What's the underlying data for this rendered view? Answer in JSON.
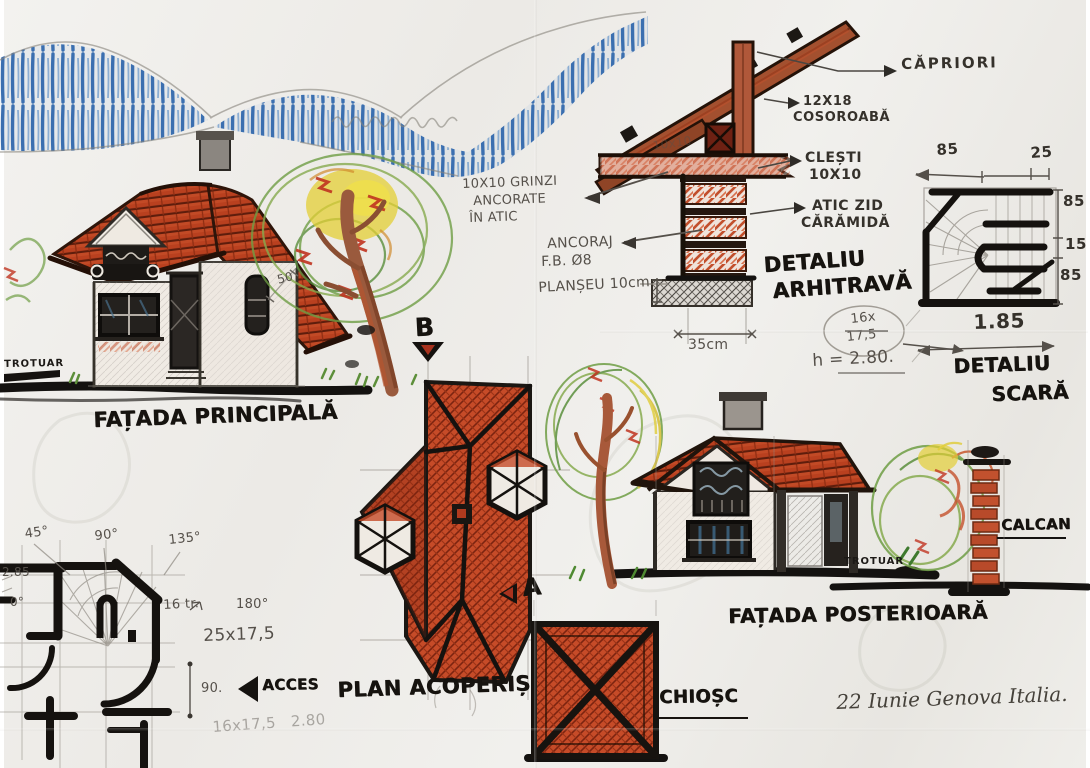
{
  "colors": {
    "paper": "#efeeea",
    "ink": "#16130f",
    "pencil": "#55504a",
    "roof_red": "#b9401f",
    "brick_red": "#c4512c",
    "sky_blue": "#3b6fb0",
    "leaf_green": "#6f9e45",
    "leaf_yellow": "#e3cf36",
    "trunk_brown": "#9a5a3d"
  },
  "facade_principala": {
    "caption": "FAȚADA PRINCIPALĂ",
    "trotuar": "TROTUAR",
    "dim_50": "50"
  },
  "facade_posterioara": {
    "caption": "FAȚADA POSTERIOARĂ",
    "trotuar": "TROTUAR",
    "calcan": "CALCAN"
  },
  "roof_plan": {
    "caption": "PLAN ACOPERIȘ",
    "acces": "ACCES",
    "marker_a": "A",
    "marker_b": "B"
  },
  "kiosk": {
    "caption": "CHIOȘC"
  },
  "detaliu_arhitrava": {
    "caption_line1": "DETALIU",
    "caption_line2": "ARHITRAVĂ",
    "capriori": "CĂPRIORI",
    "cosoroaba_line1": "12X18",
    "cosoroaba_line2": "COSOROABĂ",
    "clesti_line1": "CLEȘTI",
    "clesti_line2": "10X10",
    "atic_line1": "ATIC ZID",
    "atic_line2": "CĂRĂMIDĂ",
    "grinzi_line1": "10X10 GRINZI",
    "grinzi_line2": "ANCORATE",
    "grinzi_line3": "ÎN ATIC",
    "ancoraj_line1": "ANCORAJ",
    "ancoraj_line2": "F.B. Ø8",
    "planseu": "PLANȘEU 10cm",
    "faint_10x10": "10x10",
    "dim_35cm": "35cm",
    "steps_num": "16x",
    "steps_den": "17,5",
    "height_note": "h = 2.80."
  },
  "detaliu_scara": {
    "caption_line1": "DETALIU",
    "caption_line2": "SCARĂ",
    "dim_top_left": "85",
    "dim_top_right": "25",
    "dim_right_top": "85",
    "dim_right_mid": "15",
    "dim_right_bottom": "85",
    "dim_bottom": "1.85"
  },
  "floor_plan": {
    "angle_45": "45°",
    "angle_90": "90°",
    "angle_135": "135°",
    "angle_0": "0°",
    "angle_180": "180°",
    "dim_left": "2.85",
    "treads": "16 tr.",
    "riser": "25x17,5",
    "angle_90_dot": "90.",
    "faint_note": "16x17,5   2.80"
  },
  "signature": {
    "text": "22 Iunie Genova Italia."
  }
}
